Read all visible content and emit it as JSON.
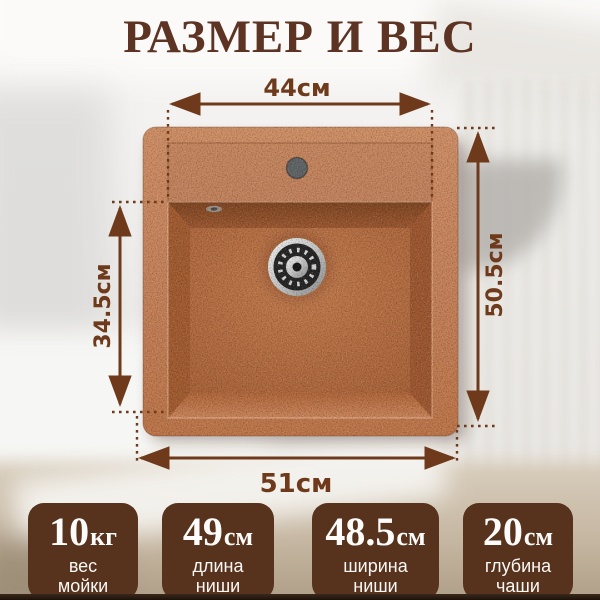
{
  "title": "РАЗМЕР И ВЕС",
  "dimensions": {
    "top": "44см",
    "bottom": "51см",
    "left": "34.5см",
    "right": "50.5см"
  },
  "specs": [
    {
      "value": "10",
      "unit": "кг",
      "lines": [
        "вес",
        "мойки"
      ]
    },
    {
      "value": "49",
      "unit": "см",
      "lines": [
        "длина",
        "ниши"
      ]
    },
    {
      "value": "48.5",
      "unit": "см",
      "lines": [
        "ширина",
        "ниши"
      ]
    },
    {
      "value": "20",
      "unit": "см",
      "lines": [
        "глубина",
        "чаши"
      ]
    }
  ],
  "colors": {
    "accent_brown": "#6e3a1b",
    "title_brown": "#5d3423",
    "spec_box_brown": "#57321d",
    "sink_terracotta": "#c5815a",
    "drain_chrome": "#d9d9d9",
    "background_light": "#efeeec"
  }
}
